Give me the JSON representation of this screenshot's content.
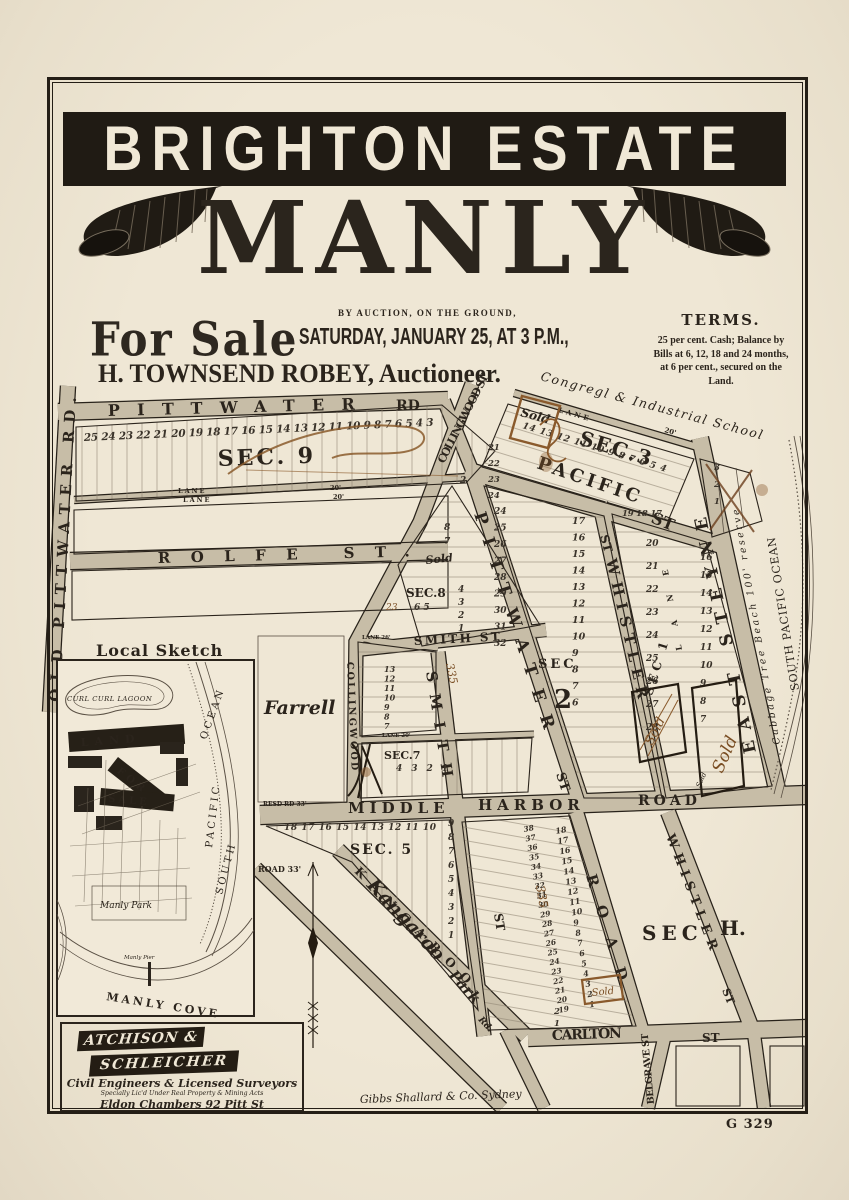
{
  "header": {
    "banner_title": "BRIGHTON ESTATE",
    "estate_name": "MANLY",
    "for_sale": "For Sale",
    "auction_line1": "BY AUCTION, ON THE GROUND,",
    "auction_line2": "SATURDAY, JANUARY 25, AT 3 P.M.,",
    "auctioneer": "H. TOWNSEND ROBEY, Auctioneer.",
    "terms": {
      "heading": "TERMS.",
      "lines": [
        "25 per cent. Cash;  Balance by",
        "Bills at 6, 12, 18 and 24 months,",
        "at 6 per cent., secured on the",
        "Land."
      ]
    }
  },
  "map": {
    "streets": {
      "pittwater": "PITTWATER",
      "rd": "RD",
      "old_pittwater_rd": "OLD PITTWATER RD.",
      "lane": "LANE",
      "lane_20": "20'",
      "lane_26": "LANE 26'",
      "lane_20_full": "LANE 20'",
      "rolfe_st": "ROLFE  ST.",
      "collingwood_st": "COLLINGWOOD ST",
      "collingwood": "COLLINGWOOD",
      "pacific": "PACIFIC",
      "st": "ST",
      "east_steyne": "EAST STEYNE",
      "whistler": "WHISTLER",
      "smith_st": "SMITH ST",
      "smith": "SMITH",
      "middle": "MIDDLE",
      "harbor": "HARBOR",
      "road": "ROAD",
      "resd_rd": "RESD RD 33'",
      "road_33": "ROAD 33'",
      "kangaroo_script": "Kangaroo",
      "park_script": "Park",
      "rd_script": "Rd.",
      "kangaroo_block": "KANGAROO",
      "carlton": "CARLTON",
      "belgrave_st": "BELGRAVE ST"
    },
    "sections": {
      "sec9": "SEC. 9",
      "sec3": "SEC.3",
      "sec8": "SEC.8",
      "sec2_a": "SEC",
      "sec2_b": "2",
      "sec1": "SEC 1",
      "sec7": "SEC.7",
      "sec5": "SEC. 5",
      "sech_a": "SEC",
      "sech_b": "H."
    },
    "places": {
      "school": "Congregl & Industrial School",
      "beach_reserve": "Cabbage Tree Beach 100' reserve",
      "ocean": "SOUTH PACIFIC OCEAN",
      "farrell": "Farrell"
    },
    "lots": {
      "sec9_row": "25 24 23 22 21 20 19 18 17 16 15 14 13 12 11 10 9 8 7 6 5 4 3",
      "sec9_extra": "2",
      "sec3_row": "14 13 12 11 10 9 8 7 6 5 4",
      "sec3_col": [
        "21",
        "22",
        "23",
        "24"
      ],
      "small_block_col": [
        "3",
        "2",
        "1"
      ],
      "sec8_top": [
        "8",
        "7"
      ],
      "sec8_right": [
        "4",
        "3",
        "2",
        "1"
      ],
      "sec8_mid": "6 5",
      "sec2_left": [
        "24",
        "25",
        "26",
        "27",
        "28",
        "29",
        "30",
        "31",
        "32"
      ],
      "sec2_right": [
        "17",
        "16",
        "15",
        "14",
        "13",
        "12",
        "11",
        "10",
        "9",
        "8",
        "7",
        "6"
      ],
      "sec1_top": "19 18 17",
      "sec1_left": [
        "20",
        "21",
        "22",
        "23",
        "24",
        "25",
        "26",
        "27",
        "28"
      ],
      "sec1_right": [
        "16",
        "15",
        "14",
        "13",
        "12",
        "11",
        "10",
        "9",
        "8",
        "7"
      ],
      "strip_col": [
        "13",
        "12",
        "11",
        "10",
        "9",
        "8",
        "7"
      ],
      "sec7_row": "4 3 2 1",
      "sec5_row": "18 17 16 15 14 13 12 11 10",
      "sec5_col": [
        "9",
        "8",
        "7",
        "6",
        "5",
        "4",
        "3",
        "2",
        "1"
      ],
      "harbor_col_a": [
        "38",
        "37",
        "36",
        "35",
        "34",
        "33",
        "32",
        "31",
        "30",
        "29",
        "28",
        "27",
        "26",
        "25",
        "24",
        "23",
        "22",
        "21",
        "20",
        "19"
      ],
      "harbor_col_b": [
        "18",
        "17",
        "16",
        "15",
        "14",
        "13",
        "12",
        "11",
        "10",
        "9",
        "8",
        "7",
        "6",
        "5",
        "4",
        "3",
        "2",
        "1"
      ],
      "carlton_col": [
        "2",
        "1"
      ]
    },
    "annotations": {
      "sold_print": "Sold",
      "sold_script": "Sold",
      "note_335": "335",
      "note_23": "23"
    },
    "inset": {
      "title": "Local Sketch",
      "lagoon": "CURL CURL LAGOON",
      "land": "LAND",
      "for_word": "FOR",
      "sale_word": "SALE",
      "park": "Manly Park",
      "pier": "Manly Pier",
      "cove": "MANLY COVE",
      "south": "SOUTH",
      "pacific": "PACIFIC",
      "ocean": "OCEAN"
    },
    "surveyor": {
      "name1": "ATCHISON &",
      "name2": "SCHLEICHER",
      "line1": "Civil Engineers & Licensed Surveyors",
      "line2": "Specially Lic'd Under Real Property & Mining Acts",
      "line3": "Eldon Chambers 92 Pitt St"
    },
    "printer_credit": "Gibbs Shallard & Co. Sydney",
    "plate_number": "G 329"
  },
  "colors": {
    "paper": "#ece3d1",
    "ink": "#2b241c",
    "road_fill": "#c7bda7",
    "banner_black": "#201b14",
    "sepia_handwriting": "#8a5a2c",
    "cream_text": "#f0e8d6"
  }
}
